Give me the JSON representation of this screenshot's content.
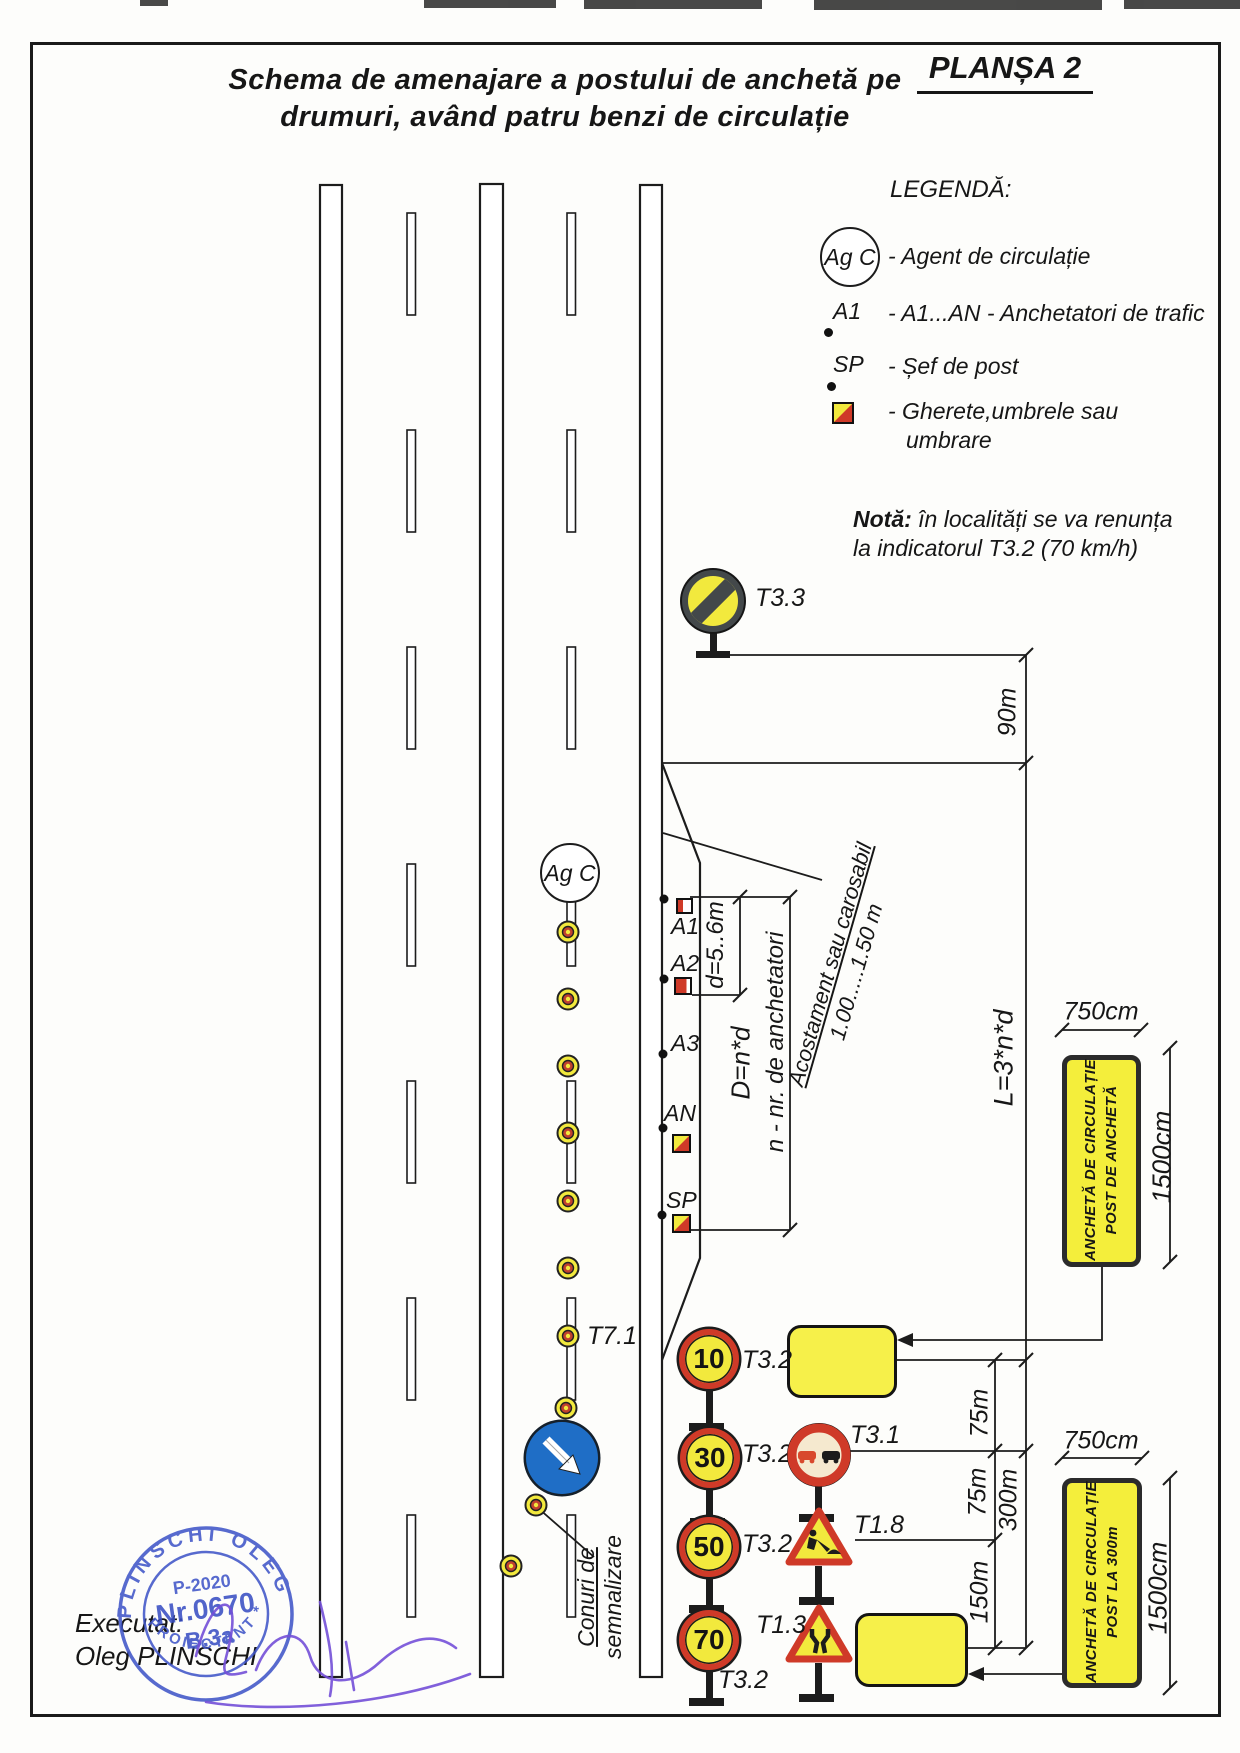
{
  "header": {
    "plansa": "PLANȘA 2",
    "title_line1": "Schema de amenajare a postului de anchetă pe",
    "title_line2": "drumuri, având patru benzi de circulație"
  },
  "legend": {
    "title": "LEGENDĂ:",
    "agent_symbol": "Ag C",
    "agent_label": "- Agent de circulație",
    "a1_symbol": "A1",
    "a1_label": "- A1...AN - Anchetatori de trafic",
    "sp_symbol": "SP",
    "sp_label": "- Șef de post",
    "booth_label_line1": "- Gherete,umbrele sau",
    "booth_label_line2": "umbrare"
  },
  "note": {
    "label": "Notă:",
    "line1": "în localități se va renunța",
    "line2": "la indicatorul T3.2 (70 km/h)"
  },
  "road_signs": {
    "t33_label": "T3.3",
    "t71_label": "T7.1",
    "t32_label": "T3.2",
    "t31_label": "T3.1",
    "t18_label": "T1.8",
    "t13_label": "T1.3",
    "speed_10": "10",
    "speed_30": "30",
    "speed_50": "50",
    "speed_70": "70"
  },
  "markers": {
    "agent": "Ag C",
    "a1": "A1",
    "a2": "A2",
    "a3": "A3",
    "an": "AN",
    "sp": "SP"
  },
  "dimensions": {
    "dist_90": "90m",
    "len_formula": "L=3*n*d",
    "spacing": "d=5..6m",
    "depth_formula": "D=n*d",
    "n_note": "n - nr. de anchetatori",
    "shoulder_line1": "Acostament sau carosabil",
    "shoulder_line2": "1.00.....1.50 m",
    "dist_75": "75m",
    "dist_150": "150m",
    "dist_300": "300m",
    "width_750": "750cm",
    "height_1500": "1500cm"
  },
  "panels": {
    "panel1_line1": "ANCHETĂ DE CIRCULAȚIE",
    "panel1_line2": "POST DE ANCHETĂ",
    "panel2_line1": "ANCHETĂ DE CIRCULAȚIE",
    "panel2_line2": "POST LA 300m"
  },
  "cones_note": {
    "line1": "Conuri de",
    "line2": "semnalizare"
  },
  "footer": {
    "executat": "Executat:",
    "author": "Oleg PLINSCHI"
  },
  "stamp": {
    "arc_top": "PLINSCHI OLEG",
    "arc_bottom": "PROIECTANT *",
    "row1": "P-2020",
    "row2": "Nr.0670",
    "row3": "B.3a"
  },
  "colors": {
    "sign_yellow": "#f2e93d",
    "sign_red": "#cf3a28",
    "sign_blue": "#1f6ec6",
    "panel_yellow": "#f4ee3b",
    "stamp_blue": "#4156c8",
    "signature_violet": "#7450d8",
    "line_dark": "#1c1c1c"
  }
}
